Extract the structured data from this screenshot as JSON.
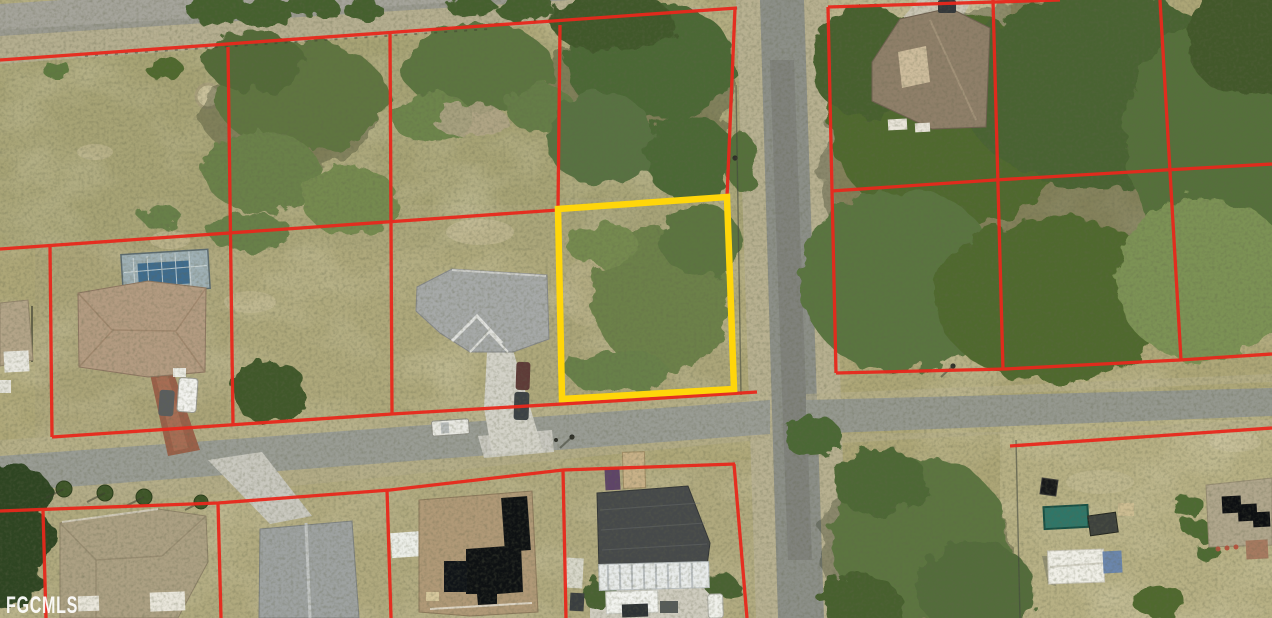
{
  "watermark": {
    "text": "FGCMLS"
  },
  "overlay": {
    "parcel_line_color": "#e8281c",
    "highlight_color": "#ffd60a"
  }
}
